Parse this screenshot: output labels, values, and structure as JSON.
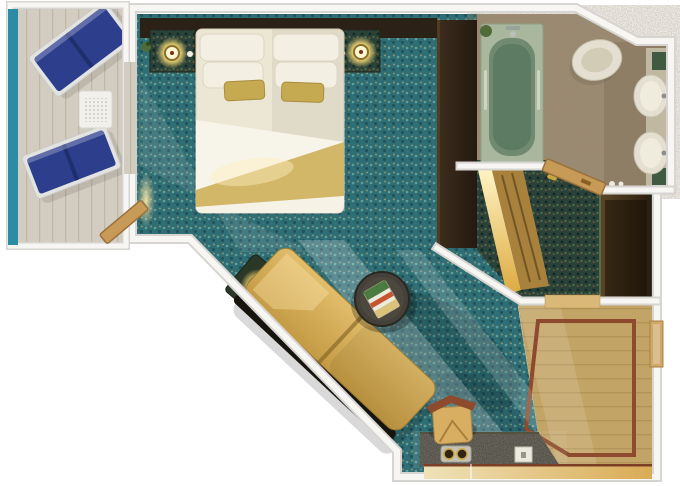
{
  "scene": {
    "kind": "cruise-stateroom-floor-plan",
    "items": [
      "balcony",
      "lounge-chair",
      "lounge-chair",
      "balcony-table",
      "balcony-railing",
      "balcony-door",
      "bedroom-carpet",
      "headboard-wall",
      "nightstand-left",
      "nightstand-right",
      "wall-lamp-left",
      "wall-lamp-right",
      "king-bed",
      "gold-blanket",
      "accent-pillows",
      "divider-wall",
      "bathroom",
      "bathtub",
      "toilet",
      "sink",
      "sink",
      "vanity-counter",
      "dressing-room",
      "lit-wardrobe",
      "closet",
      "bathroom-door",
      "entry-foyer",
      "wood-floor-inlay",
      "entry-door",
      "sofa",
      "coffee-table",
      "magazine",
      "side-table",
      "table-lamp",
      "vanity-desk",
      "desk-chair",
      "coffee-tray",
      "notepad"
    ]
  },
  "colors": {
    "background": "#ffffff",
    "wall_fill": "#f7f6f3",
    "wall_edge": "#d7d5d1",
    "deck": "#d3ccc0",
    "deck_line": "#bfb7a9",
    "railing_teal": "#2a8da3",
    "lounger_blue": "#2c3e8c",
    "lounger_blue_dark": "#1f2f6e",
    "lounger_frame": "#e3e3e1",
    "balcony_table_white": "#f2f0ea",
    "table_hole": "#b3b1a8",
    "carpet_teal": "#2f6e74",
    "carpet_dot_light": "#7ab1a9",
    "carpet_dot_dark": "#1d4a52",
    "carpet_dot_gold": "#c2a46b",
    "carpet_dot_deep": "#255f66",
    "headboard_dark": "#2b2117",
    "nightstand_green": "#26302a",
    "lamp_gold": "#e8cf6f",
    "lamp_glow_center": "#fff7cf",
    "lamp_ring": "#8a6f2f",
    "lamp_dot": "#7a2e1e",
    "bed_linen": "#ece6d4",
    "bed_fold_white": "#f7f4ea",
    "bed_sheet_white": "#f6f2e6",
    "blanket_gold": "#d2b768",
    "pillow_white": "#f3efe2",
    "pillow_gold": "#c6aa52",
    "divider_brown_1": "#3d2d1d",
    "divider_brown_2": "#241a10",
    "tub_surround": "#a9b79f",
    "tub_rim": "#6f8a70",
    "tub_water": "#5d7a63",
    "bathroom_tile": "#9b8b72",
    "porcelain": "#e4dfd0",
    "porcelain_inner": "#efebdd",
    "counter_green": "#3f5a41",
    "counter_strip": "#c6bfa8",
    "dressing_carpet": "#2a423a",
    "dress_dot_dark": "#122b24",
    "dress_dot_green": "#5c7a4d",
    "dress_dot_brown": "#7c5c33",
    "wardrobe_glow_1": "#fff3c2",
    "wardrobe_glow_2": "#dca940",
    "wardrobe_front": "#a8823c",
    "closet_brown_1": "#5a4526",
    "closet_brown_2": "#2a1d0e",
    "wood_floor": "#c3a467",
    "wood_line": "#a8894e",
    "wood_border_red": "#8d4a2e",
    "threshold_tan": "#d9b878",
    "door_wood": "#c89a58",
    "door_wood_edge": "#9a713a",
    "entry_door": "#cfa869",
    "sofa_gold_1": "#e2bd6b",
    "sofa_gold_2": "#c49a44",
    "sofa_back_dark": "#17140e",
    "table_dark": "#44413a",
    "magazine_green": "#4a7c3f",
    "magazine_red": "#c4552e",
    "magazine_tan": "#d9c27a",
    "vanity_counter": "#3a372e",
    "chair_tan": "#d8ae63",
    "chair_rail_red": "#8d4a2c",
    "desk_front_1": "#efe2b8",
    "desk_front_2": "#d9ab55",
    "desk_line_red": "#7a3f24",
    "tray_gray": "#cfccc0",
    "cup_dark": "#2f2416",
    "cup_rim_gold": "#caa53f",
    "notepad_white": "#eceade",
    "plant_green": "#4e6b38"
  }
}
